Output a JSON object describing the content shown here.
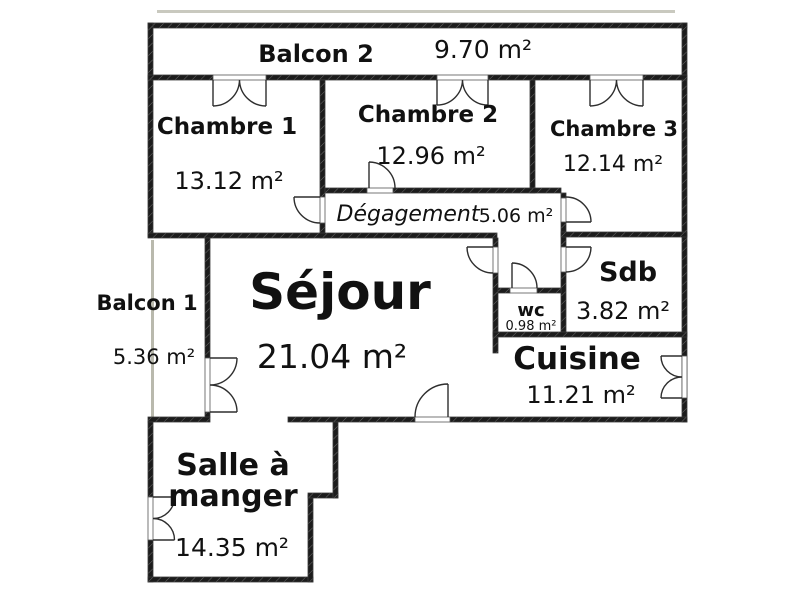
{
  "rooms": {
    "balcon2": {
      "name": "Balcon 2",
      "area": "9.70 m²"
    },
    "chambre1": {
      "name": "Chambre 1",
      "area": "13.12 m²"
    },
    "chambre2": {
      "name": "Chambre 2",
      "area": "12.96 m²"
    },
    "chambre3": {
      "name": "Chambre 3",
      "area": "12.14 m²"
    },
    "degagement": {
      "name": "Dégagement",
      "area": "5.06 m²"
    },
    "balcon1": {
      "name": "Balcon 1",
      "area": "5.36 m²"
    },
    "sejour": {
      "name": "Séjour",
      "area": "21.04 m²"
    },
    "wc": {
      "name": "wc",
      "area": "0.98 m²"
    },
    "sdb": {
      "name": "Sdb",
      "area": "3.82 m²"
    },
    "cuisine": {
      "name": "Cuisine",
      "area": "11.21 m²"
    },
    "salle_a_manger": {
      "name": "Salle à manger",
      "name_line1": "Salle à",
      "name_line2": "manger",
      "area": "14.35 m²"
    }
  },
  "colors": {
    "wall": "#1c1c1c",
    "door": "#2e2e2e",
    "railing": "#b9b9ad",
    "overhang": "#c9c9bf"
  }
}
